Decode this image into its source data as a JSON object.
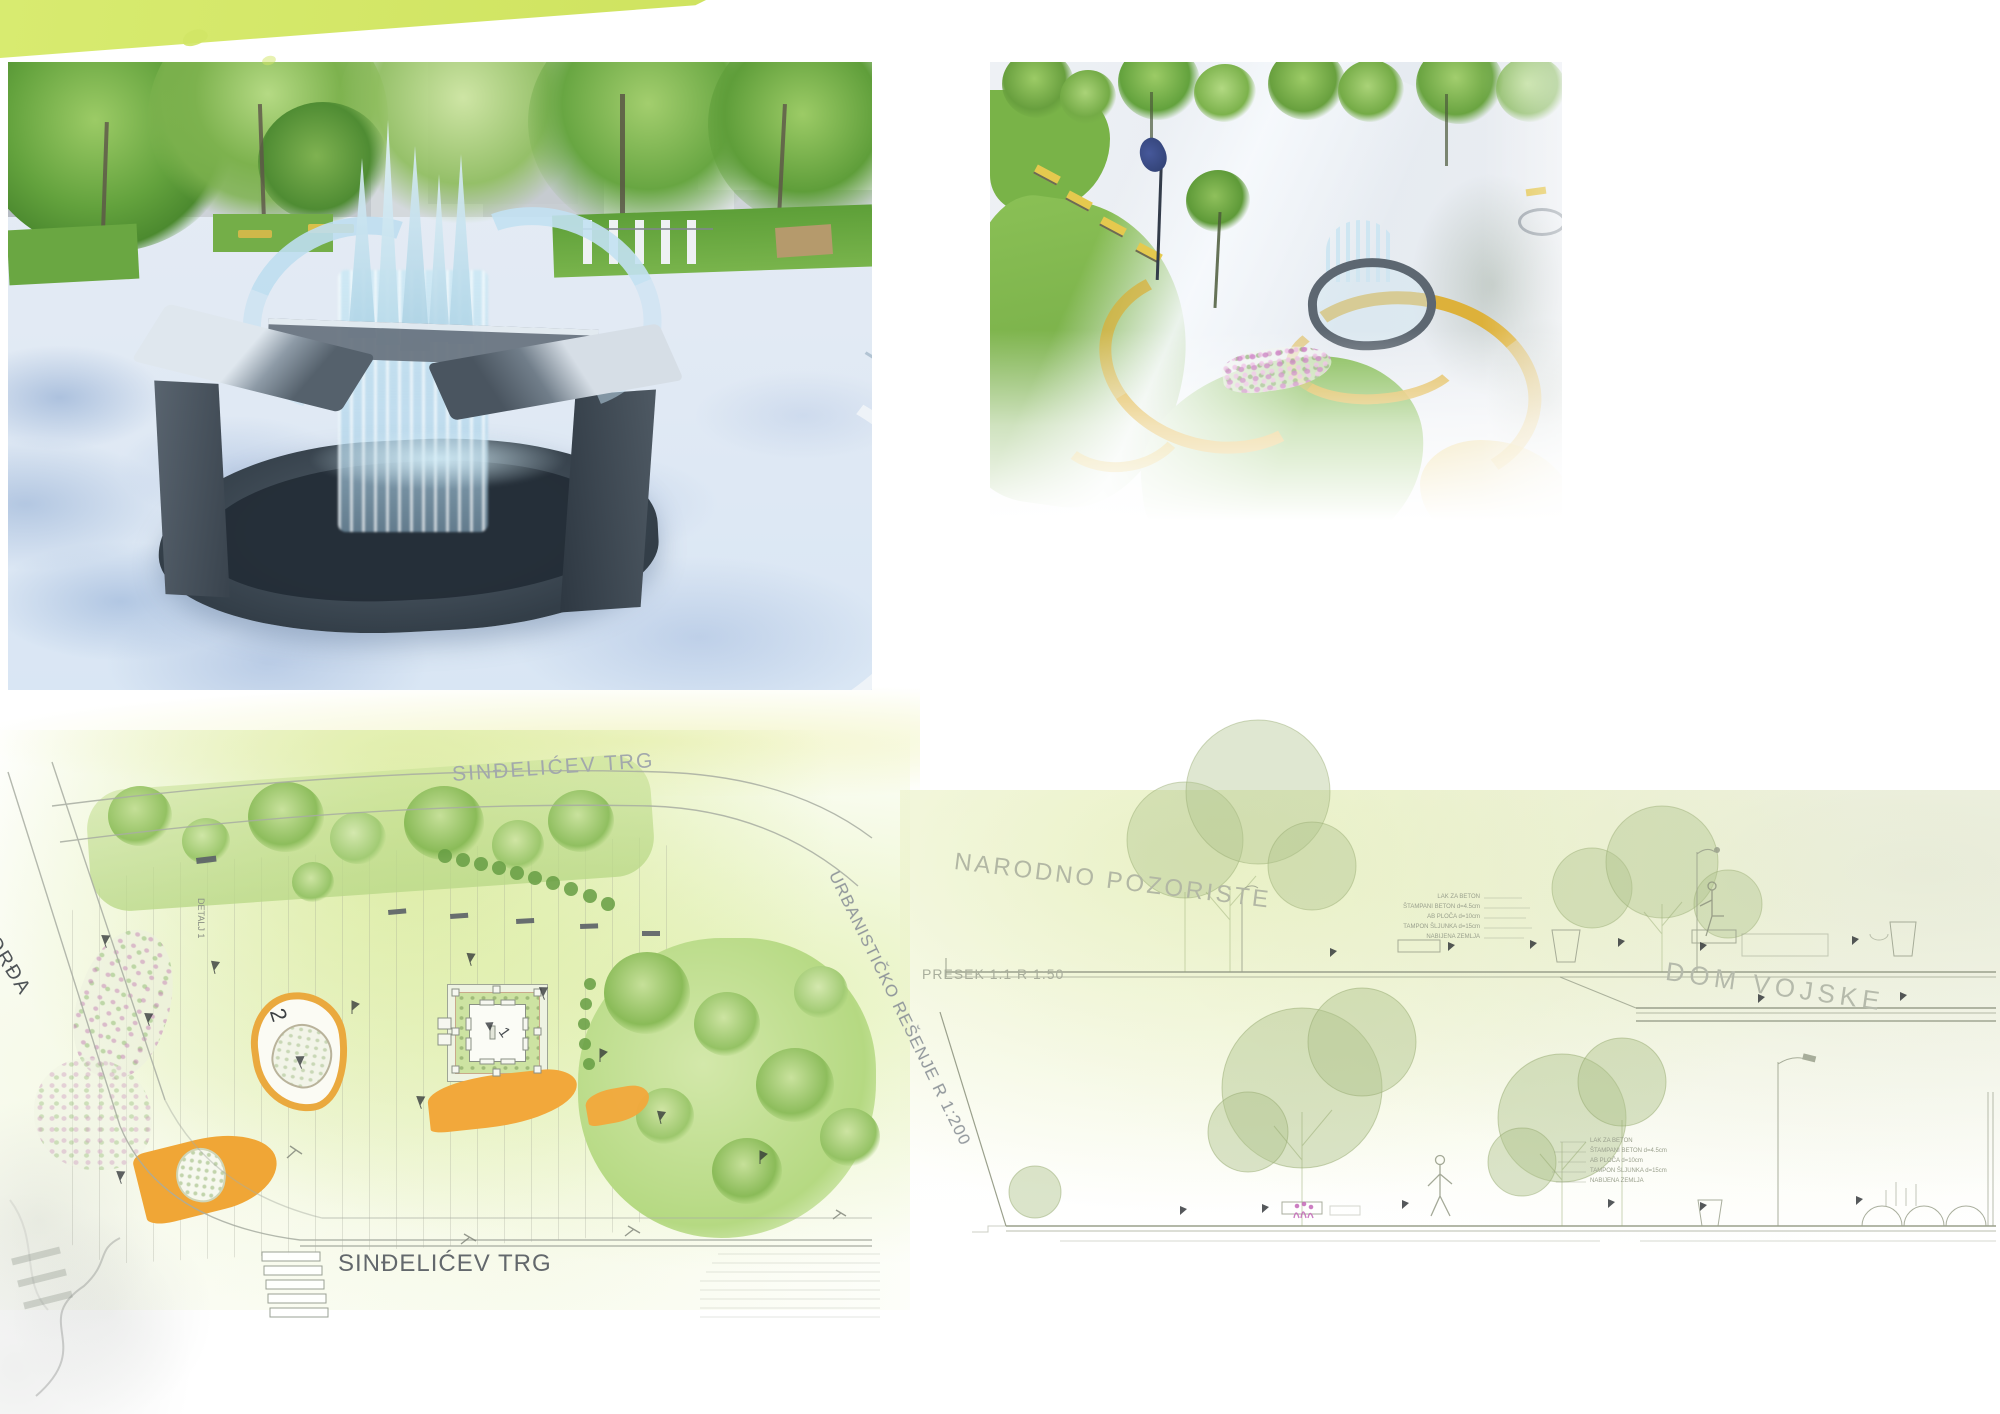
{
  "colors": {
    "accent_lime": "#d5e96b",
    "ribbon_yellow": "#d7a41d",
    "path_orange": "#f0a83a",
    "lawn_green": "#7cb64b",
    "flower_purple": "#bc6fb4"
  },
  "plan": {
    "title": "URBANISTIČKO REŠENJE R 1:200",
    "street_top": "SINĐELIĆEV TRG",
    "street_bottom": "SINĐELIĆEV TRG",
    "street_left": "ĐORĐA",
    "detail_label": "DETALJ 1",
    "marker_fountain": "1",
    "marker_sculpture": "2"
  },
  "sections": {
    "upper_title": "NARODNO POZORISTE",
    "scale_label": "PRESEK 1:1 R 1:50",
    "lower_title": "DOM VOJSKE",
    "pavement_layers": [
      "LAK ZA BETON",
      "ŠTAMPANI BETON d=4.5cm",
      "AB PLOČA d=10cm",
      "TAMPON ŠLJUNKA d=15cm",
      "NABIJENA ZEMLJA"
    ]
  }
}
